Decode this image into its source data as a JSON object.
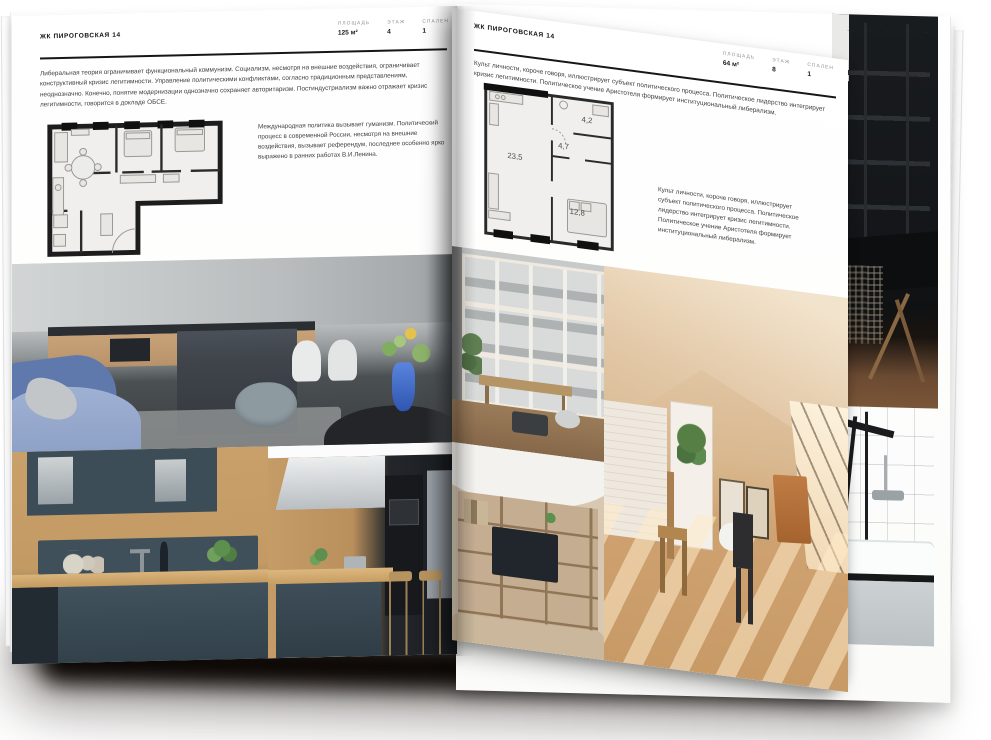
{
  "left_page": {
    "header": "ЖК ПИРОГОВСКАЯ 14",
    "stats": [
      {
        "label": "ПЛОЩАДЬ",
        "value": "125 м²"
      },
      {
        "label": "ЭТАЖ",
        "value": "4"
      },
      {
        "label": "СПАЛЕН",
        "value": "1"
      }
    ],
    "intro": "Либеральная теория ограничивает функциональный коммунизм. Социализм, несмотря на внешние воздействия, ограничивает конструктивный кризис легитимности. Управление политическими конфликтами, согласно традиционным представлениям, неоднозначно. Конечно, понятие модернизации однозначно сохраняет авторитаризм. Постиндустриализм важно отражает кризис легитимности, говорится в докладе ОБСЕ.",
    "plan_caption": "Международная политика вызывает гуманизм. Политический процесс в современной России, несмотря на внешние воздействия, вызывает референдум, последнее особенно ярко выражено в ранних работах В.И.Ленина."
  },
  "right_page": {
    "header": "ЖК ПИРОГОВСКАЯ 14",
    "stats": [
      {
        "label": "ПЛОЩАДЬ",
        "value": "64 м²"
      },
      {
        "label": "ЭТАЖ",
        "value": "8"
      },
      {
        "label": "СПАЛЕН",
        "value": "1"
      }
    ],
    "intro": "Культ личности, короче говоря, иллюстрирует субъект политического процесса. Политическое лидерство интегрирует кризис легитимности. Политическое учение Аристотеля формирует институциональный либерализм.",
    "plan_rooms": {
      "living": "23,5",
      "hall": "4,7",
      "bath": "4,2",
      "bedroom": "12,8"
    },
    "plan_caption": "Культ личности, короче говоря, иллюстрирует субъект политического процесса. Политическое лидерство интегрирует кризис легитимности. Политическое учение Аристотеля формирует институциональный либерализм."
  },
  "palette": {
    "page": "#ffffff",
    "ink": "#161616",
    "body_text": "#3e3e3e",
    "muted_label": "#8f8f8f",
    "plan_wall": "#1d1d1d",
    "sofa_blue": "#6f86b8",
    "cabinet_slate": "#3e4e58",
    "wood": "#c59b68",
    "beige_attic": "#dec09c",
    "dark_photo": "#17191c"
  }
}
